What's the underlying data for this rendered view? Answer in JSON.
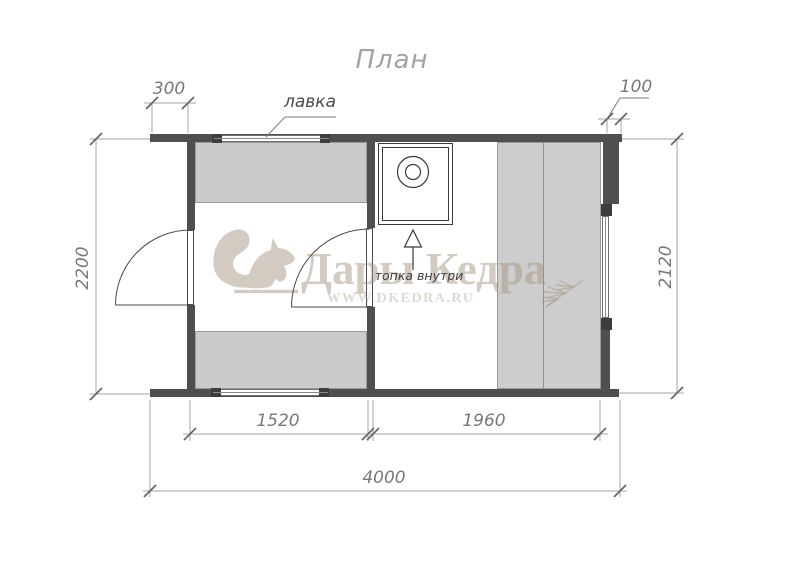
{
  "title": "План",
  "plan_labels": {
    "bench_label": "лавка",
    "stove_label": "топка внутри"
  },
  "dimensions_mm": {
    "top_left": "300",
    "top_right": "100",
    "left_side": "2200",
    "right_side": "2120",
    "bottom_left": "1520",
    "bottom_right": "1960",
    "bottom_total": "4000"
  },
  "watermark": {
    "brand": "Дары Кедра",
    "website": "WWW.DKEDRA.RU"
  },
  "icons": [
    "squirrel-logo-icon",
    "cedar-branch-icon",
    "stove-icon",
    "direction-arrow-icon"
  ],
  "colors": {
    "wall": "#4f4f4f",
    "bench_fill": "#cbcbcb",
    "dimension_line": "#a6a6a6",
    "dimension_text": "#787878",
    "watermark_beige": "#d6cec4"
  }
}
